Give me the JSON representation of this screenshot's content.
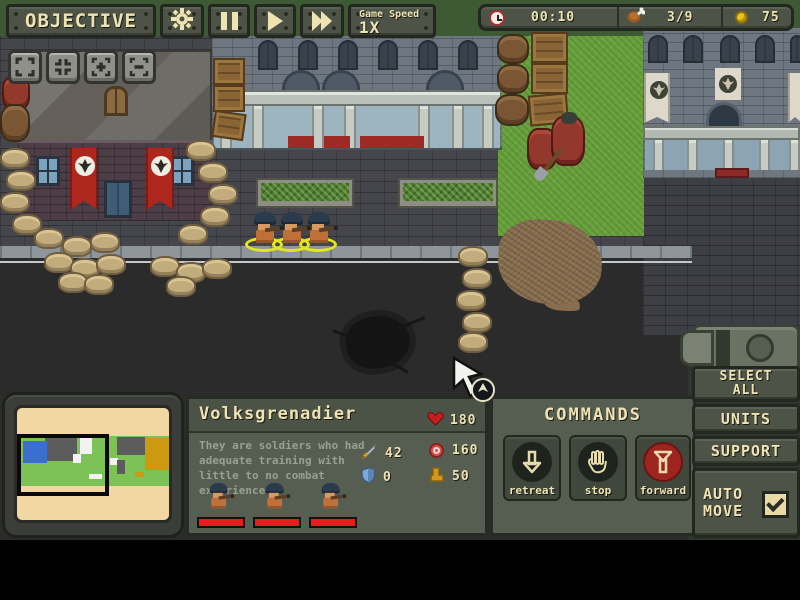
{
  "top_bar": {
    "objective": "OBJECTIVE",
    "game_speed_label": "Game Speed",
    "game_speed_value": "1X"
  },
  "resources": {
    "time": "00:10",
    "rations": "3/9",
    "coins": "75"
  },
  "unit_panel": {
    "name": "Volksgrenadier",
    "hp": "180",
    "description": "They are soldiers who had adequate training with little to no combat experience",
    "attack": "42",
    "cost": "160",
    "armor": "0",
    "move": "50",
    "squad_count": 3,
    "squad_health_pct": [
      100,
      100,
      100
    ]
  },
  "commands": {
    "title": "COMMANDS",
    "retreat": "retreat",
    "stop": "stop",
    "forward": "forward"
  },
  "side_panel": {
    "select_all": "SELECT ALL",
    "units": "UNITS",
    "support": "SUPPORT",
    "auto_move": "AUTO MOVE",
    "auto_move_checked": true
  },
  "icons": {
    "gear": "settings gear",
    "pause": "pause bars",
    "play": "play triangle",
    "fast_forward": "double triangle",
    "clock": "timer clock",
    "drumstick": "ration food",
    "coin": "gold coin",
    "heart": "hit points",
    "sword": "attack",
    "target": "cost/ammo",
    "shield": "armor",
    "boot": "movement",
    "camera": [
      "expand-frame",
      "contract-frame",
      "zoom-in",
      "zoom-out"
    ]
  },
  "colors": {
    "ui_panel": "#4d5447",
    "ui_border": "#23271f",
    "text_beige": "#efe3b4",
    "forward_red": "#9e2420",
    "selection_yellow": "#e3e71b",
    "health_red": "#e81c1c",
    "minimap_bg": "#f3d7a2"
  }
}
